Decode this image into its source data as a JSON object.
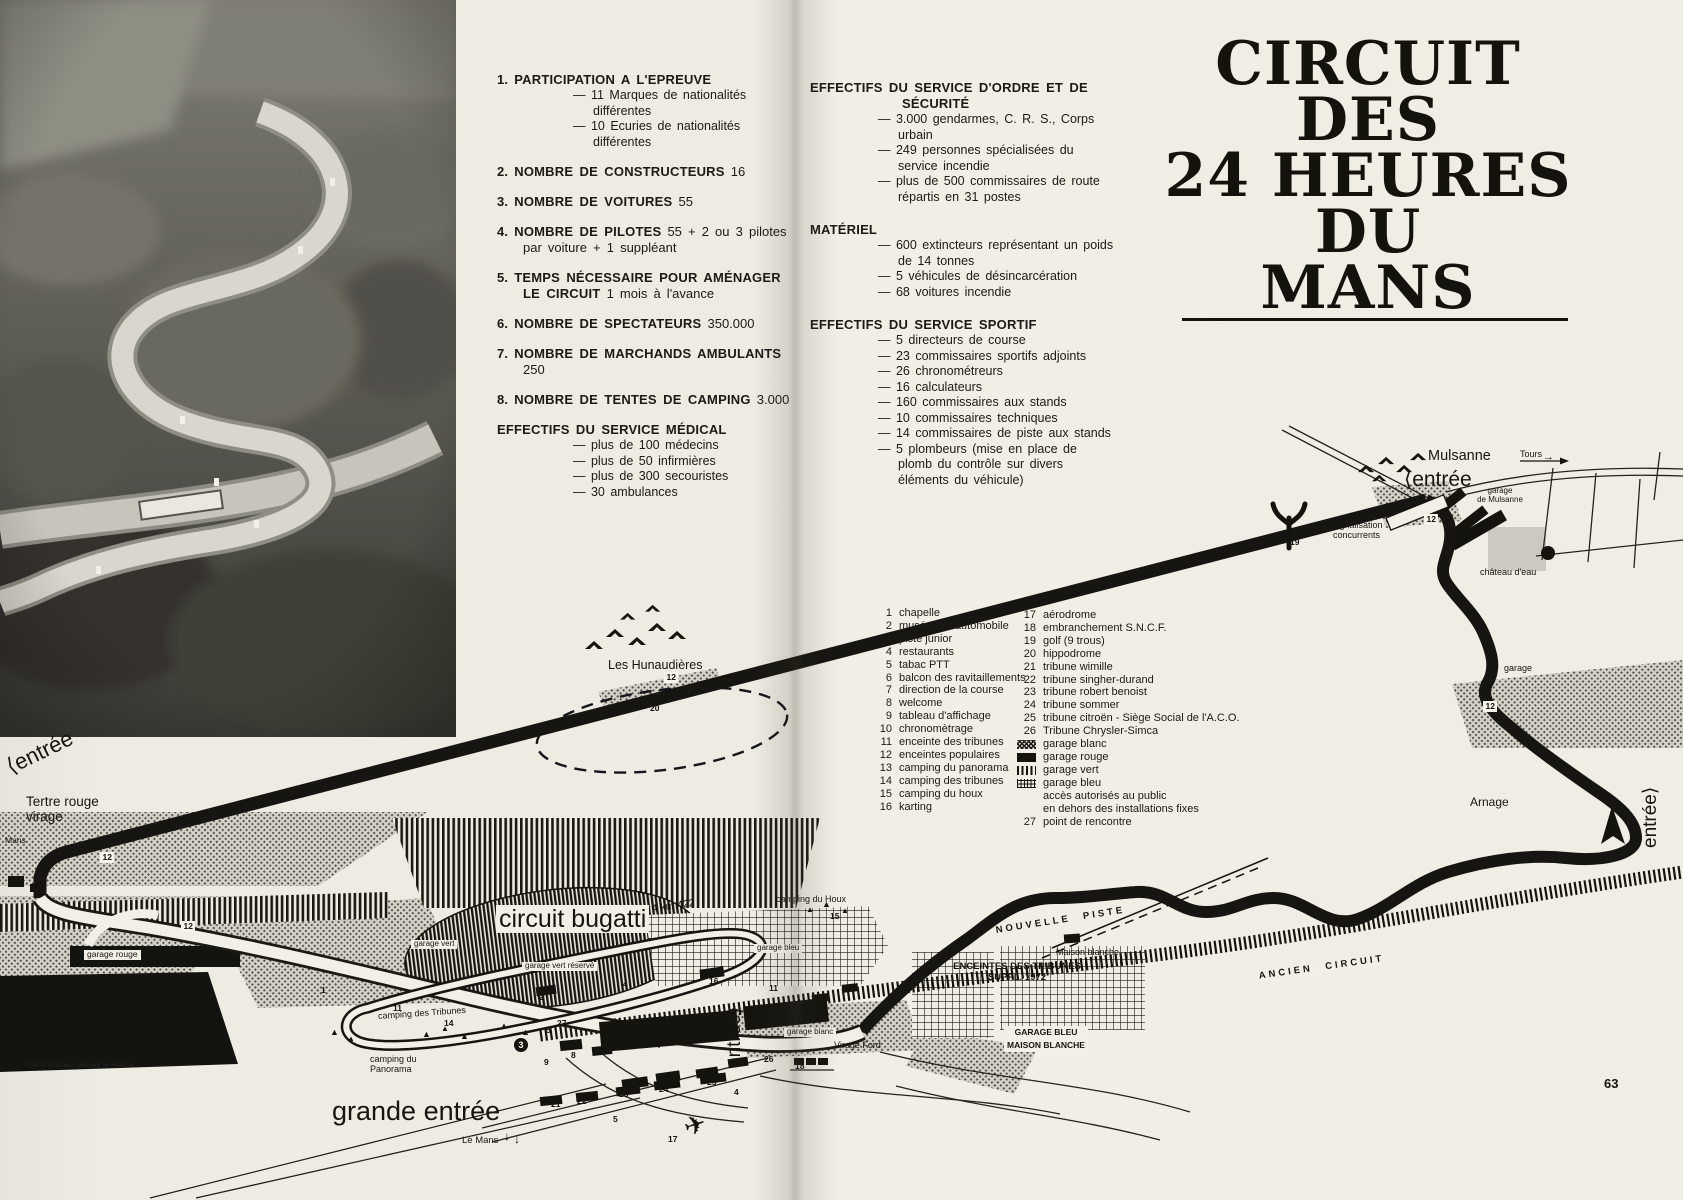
{
  "page": {
    "footer_left": "O P G conseil - printed in France",
    "page_number": "63"
  },
  "colors": {
    "paper": "#efece3",
    "ink": "#1b1a16"
  },
  "title": {
    "lines": [
      "CIRCUIT",
      "DES",
      "24 HEURES",
      "DU",
      "MANS"
    ]
  },
  "stats_left": {
    "items": [
      {
        "num": "1.",
        "title": "PARTICIPATION A L'EPREUVE",
        "value": "",
        "subs": [
          "— 11 Marques de nationalités différentes",
          "— 10 Ecuries de nationalités différentes"
        ]
      },
      {
        "num": "2.",
        "title": "NOMBRE DE CONSTRUCTEURS",
        "value": "16"
      },
      {
        "num": "3.",
        "title": "NOMBRE DE VOITURES",
        "value": "55"
      },
      {
        "num": "4.",
        "title": "NOMBRE DE PILOTES",
        "value": "55 + 2 ou 3 pilotes par voiture + 1 suppléant"
      },
      {
        "num": "5.",
        "title": "TEMPS NÉCESSAIRE POUR AMÉNAGER LE CIRCUIT",
        "value": "1 mois à l'avance"
      },
      {
        "num": "6.",
        "title": "NOMBRE DE SPECTATEURS",
        "value": "350.000"
      },
      {
        "num": "7.",
        "title": "NOMBRE DE MARCHANDS AMBULANTS",
        "value": "250"
      },
      {
        "num": "8.",
        "title": "NOMBRE DE TENTES DE CAMPING",
        "value": "3.000"
      },
      {
        "num": "",
        "title": "EFFECTIFS DU SERVICE MÉDICAL",
        "value": "",
        "subs": [
          "— plus de 100 médecins",
          "— plus de 50 infirmières",
          "— plus de 300 secouristes",
          "— 30 ambulances"
        ]
      }
    ]
  },
  "stats_right": {
    "sections": [
      {
        "title": "EFFECTIFS DU SERVICE D'ORDRE ET DE SÉCURITÉ",
        "subs": [
          "— 3.000 gendarmes, C. R. S., Corps urbain",
          "— 249 personnes spécialisées du service incendie",
          "— plus de 500 commissaires de route répartis en 31 postes"
        ]
      },
      {
        "title": "MATÉRIEL",
        "subs": [
          "— 600 extincteurs représentant un poids de 14 tonnes",
          "— 5 véhicules de désincarcération",
          "— 68 voitures incendie"
        ]
      },
      {
        "title": "EFFECTIFS DU SERVICE SPORTIF",
        "subs": [
          "— 5 directeurs de course",
          "— 23 commissaires sportifs adjoints",
          "— 26 chronométreurs",
          "— 16 calculateurs",
          "— 160 commissaires aux stands",
          "— 10 commissaires techniques",
          "— 14 commissaires de piste aux stands",
          "— 5 plombeurs (mise en place de plomb du contrôle sur divers éléments du véhicule)"
        ]
      }
    ]
  },
  "legend": {
    "col1": [
      {
        "n": "1",
        "label": "chapelle"
      },
      {
        "n": "2",
        "label": "musée de l'automobile"
      },
      {
        "n": "3",
        "label": "piste junior"
      },
      {
        "n": "4",
        "label": "restaurants"
      },
      {
        "n": "5",
        "label": "tabac PTT"
      },
      {
        "n": "6",
        "label": "balcon des ravitaillements"
      },
      {
        "n": "7",
        "label": "direction de la course"
      },
      {
        "n": "8",
        "label": "welcome"
      },
      {
        "n": "9",
        "label": "tableau d'affichage"
      },
      {
        "n": "10",
        "label": "chronomètrage"
      },
      {
        "n": "11",
        "label": "enceinte des tribunes"
      },
      {
        "n": "12",
        "label": "enceintes populaires"
      },
      {
        "n": "13",
        "label": "camping du panorama"
      },
      {
        "n": "14",
        "label": "camping des tribunes"
      },
      {
        "n": "15",
        "label": "camping du houx"
      },
      {
        "n": "16",
        "label": "karting"
      }
    ],
    "col2": [
      {
        "n": "17",
        "label": "aérodrome"
      },
      {
        "n": "18",
        "label": "embranchement S.N.C.F."
      },
      {
        "n": "19",
        "label": "golf (9 trous)"
      },
      {
        "n": "20",
        "label": "hippodrome"
      },
      {
        "n": "21",
        "label": "tribune wimille"
      },
      {
        "n": "22",
        "label": "tribune singher-durand"
      },
      {
        "n": "23",
        "label": "tribune robert benoist"
      },
      {
        "n": "24",
        "label": "tribune citroën - Siège Social de l'A.C.O.",
        "override_n": "25"
      },
      {
        "n": "24x",
        "label": ""
      },
      {
        "n": "26",
        "label": "Tribune Chrysler-Simca"
      },
      {
        "swatch": "dots",
        "label": "garage blanc"
      },
      {
        "swatch": "solid",
        "label": "garage rouge"
      },
      {
        "swatch": "vlines",
        "label": "garage vert"
      },
      {
        "swatch": "grid",
        "label": "garage bleu"
      },
      {
        "label": "accès autorisés au public"
      },
      {
        "label": "en dehors des installations fixes"
      },
      {
        "n": "27",
        "label": "point de rencontre"
      }
    ],
    "col2_fixed": [
      {
        "n": "17",
        "label": "aérodrome"
      },
      {
        "n": "18",
        "label": "embranchement S.N.C.F."
      },
      {
        "n": "19",
        "label": "golf (9 trous)"
      },
      {
        "n": "20",
        "label": "hippodrome"
      },
      {
        "n": "21",
        "label": "tribune wimille"
      },
      {
        "n": "22",
        "label": "tribune singher-durand"
      },
      {
        "n": "23",
        "label": "tribune robert benoist"
      },
      {
        "n": "24",
        "label": "tribune sommer"
      },
      {
        "n": "25",
        "label": "tribune citroën - Siège Social de l'A.C.O."
      },
      {
        "n": "26",
        "label": "Tribune Chrysler-Simca"
      },
      {
        "swatch": "dots",
        "label": "garage blanc"
      },
      {
        "swatch": "solid",
        "label": "garage rouge"
      },
      {
        "swatch": "vlines",
        "label": "garage vert"
      },
      {
        "swatch": "grid",
        "label": "garage bleu"
      },
      {
        "label": "accès autorisés au public"
      },
      {
        "label": "en dehors des installations fixes"
      },
      {
        "n": "27",
        "label": "point de rencontre"
      }
    ]
  },
  "map": {
    "labels": [
      {
        "name": "label-les-hunaudieres",
        "text": "Les Hunaudières",
        "x": 608,
        "y": 658,
        "size": 12.5
      },
      {
        "name": "label-entree-tertre",
        "text": "⟨entrée",
        "x": 8,
        "y": 756,
        "size": 22,
        "rotate": -26
      },
      {
        "name": "label-tertre-rouge",
        "text": "Tertre rouge\nvirage",
        "x": 26,
        "y": 794,
        "size": 13.5
      },
      {
        "name": "label-mans",
        "text": "Mans",
        "x": 5,
        "y": 836,
        "size": 8.5
      },
      {
        "name": "label-garage-rouge",
        "text": "garage rouge",
        "x": 84,
        "y": 950,
        "size": 8.5,
        "boxed": true
      },
      {
        "name": "label-camping-panorama",
        "text": "camping du\nPanorama",
        "x": 370,
        "y": 1054,
        "size": 9
      },
      {
        "name": "label-camping-tribunes",
        "text": "camping des Tribunes",
        "x": 378,
        "y": 1011,
        "size": 9,
        "rotate": -4
      },
      {
        "name": "label-circuit-bugatti",
        "text": "circuit bugatti",
        "x": 496,
        "y": 905,
        "size": 25,
        "boxed": true
      },
      {
        "name": "label-bugatti-length",
        "text": "4 km 422",
        "x": 652,
        "y": 904,
        "size": 10.5,
        "rotate": -8
      },
      {
        "name": "label-garage-vert",
        "text": "garage vert",
        "x": 411,
        "y": 940,
        "size": 8,
        "boxed": true
      },
      {
        "name": "label-garage-vert-reserve",
        "text": "garage vert réservé",
        "x": 522,
        "y": 962,
        "size": 8,
        "boxed": true
      },
      {
        "name": "label-garage-bleu",
        "text": "garage bleu",
        "x": 754,
        "y": 944,
        "size": 8,
        "boxed": true
      },
      {
        "name": "label-camping-houx",
        "text": "camping du Houx",
        "x": 776,
        "y": 894,
        "size": 9
      },
      {
        "name": "label-grande-entree",
        "text": "grande entrée",
        "x": 332,
        "y": 1096,
        "size": 27
      },
      {
        "name": "label-le-mans",
        "text": "Le Mans",
        "x": 462,
        "y": 1136,
        "size": 9.5
      },
      {
        "name": "label-entree-centre",
        "text": "entrée⟩",
        "x": 724,
        "y": 1068,
        "size": 19,
        "rotate": -90
      },
      {
        "name": "label-virage-ford",
        "text": "Virage Ford",
        "x": 834,
        "y": 1040,
        "size": 9
      },
      {
        "name": "label-garage-blanc",
        "text": "garage blanc",
        "x": 784,
        "y": 1028,
        "size": 8,
        "boxed": true
      },
      {
        "name": "label-nouvelle-piste",
        "text": "NOUVELLE PISTE",
        "x": 996,
        "y": 926,
        "size": 9.5,
        "rotate": -9,
        "spaced": true
      },
      {
        "name": "label-enceintes-suppl",
        "text": "ENCEINTES DES TRIBUNES\nSUPPL. 1972",
        "x": 1017,
        "y": 962,
        "size": 9.5,
        "bold": true,
        "align": "center"
      },
      {
        "name": "label-ancien-circuit",
        "text": "ANCIEN CIRCUIT",
        "x": 1256,
        "y": 972,
        "size": 9.5,
        "rotate": -8,
        "spaced": true,
        "boxed": true
      },
      {
        "name": "label-maison-blanche",
        "text": "Maison blanche",
        "x": 1056,
        "y": 947,
        "size": 9
      },
      {
        "name": "label-garage-bleu-maison-blanche",
        "text": "GARAGE BLEU\nMAISON BLANCHE",
        "x": 1046,
        "y": 1026,
        "size": 8.5,
        "bold": true,
        "boxed": true,
        "align": "center",
        "lh": "1.55"
      },
      {
        "name": "label-mulsanne",
        "text": "Mulsanne",
        "x": 1428,
        "y": 448,
        "size": 14.5
      },
      {
        "name": "label-tours",
        "text": "Tours",
        "x": 1520,
        "y": 449,
        "size": 9
      },
      {
        "name": "label-entree-mulsanne",
        "text": "⟨entrée",
        "x": 1404,
        "y": 468,
        "size": 21
      },
      {
        "name": "label-garage-de-mulsanne",
        "text": "garage\nde Mulsanne",
        "x": 1500,
        "y": 487,
        "size": 8,
        "align": "center"
      },
      {
        "name": "label-signalisation",
        "text": "signalisation\nconcurrents",
        "x": 1333,
        "y": 520,
        "size": 9
      },
      {
        "name": "label-chateau-eau",
        "text": "château d'eau",
        "x": 1480,
        "y": 567,
        "size": 9
      },
      {
        "name": "label-garage-arnage",
        "text": "garage",
        "x": 1504,
        "y": 663,
        "size": 9
      },
      {
        "name": "label-arnage",
        "text": "Arnage",
        "x": 1470,
        "y": 796,
        "size": 12
      },
      {
        "name": "label-entree-arnage",
        "text": "entrée⟩",
        "x": 1640,
        "y": 848,
        "size": 19,
        "rotate": -90
      }
    ],
    "numbers": [
      {
        "n": "12",
        "x": 664,
        "y": 672,
        "boxed": true
      },
      {
        "n": "20",
        "x": 650,
        "y": 704
      },
      {
        "n": "19",
        "x": 1290,
        "y": 538
      },
      {
        "n": "12",
        "x": 1424,
        "y": 514,
        "boxed": true
      },
      {
        "n": "12",
        "x": 1483,
        "y": 701,
        "boxed": true
      },
      {
        "n": "12",
        "x": 100,
        "y": 852,
        "boxed": true
      },
      {
        "n": "12",
        "x": 181,
        "y": 921,
        "boxed": true
      },
      {
        "n": "1",
        "x": 321,
        "y": 986
      },
      {
        "n": "2",
        "x": 539,
        "y": 993
      },
      {
        "n": "3",
        "x": 514,
        "y": 1038,
        "circle": true
      },
      {
        "n": "5",
        "x": 546,
        "y": 1026
      },
      {
        "n": "27",
        "x": 557,
        "y": 1019
      },
      {
        "n": "9",
        "x": 544,
        "y": 1058
      },
      {
        "n": "8",
        "x": 571,
        "y": 1051
      },
      {
        "n": "6",
        "x": 630,
        "y": 1024
      },
      {
        "n": "7",
        "x": 657,
        "y": 1041
      },
      {
        "n": "10",
        "x": 791,
        "y": 1017
      },
      {
        "n": "11",
        "x": 769,
        "y": 984
      },
      {
        "n": "11",
        "x": 393,
        "y": 1004
      },
      {
        "n": "14",
        "x": 444,
        "y": 1019
      },
      {
        "n": "15",
        "x": 830,
        "y": 912
      },
      {
        "n": "16",
        "x": 709,
        "y": 977
      },
      {
        "n": "21",
        "x": 551,
        "y": 1100
      },
      {
        "n": "22",
        "x": 577,
        "y": 1097
      },
      {
        "n": "23",
        "x": 619,
        "y": 1090
      },
      {
        "n": "24",
        "x": 659,
        "y": 1085
      },
      {
        "n": "25",
        "x": 707,
        "y": 1078
      },
      {
        "n": "4",
        "x": 623,
        "y": 980
      },
      {
        "n": "4",
        "x": 734,
        "y": 1088
      },
      {
        "n": "5",
        "x": 613,
        "y": 1115
      },
      {
        "n": "17",
        "x": 668,
        "y": 1135
      },
      {
        "n": "26",
        "x": 764,
        "y": 1055
      },
      {
        "n": "18",
        "x": 795,
        "y": 1062
      }
    ],
    "icons": [
      {
        "name": "tent-icon",
        "glyph": "▲",
        "x": 330,
        "y": 1028,
        "size": 9
      },
      {
        "name": "tent-icon",
        "glyph": "▲",
        "x": 347,
        "y": 1035,
        "size": 8
      },
      {
        "name": "tent-icon",
        "glyph": "▲",
        "x": 422,
        "y": 1030,
        "size": 9
      },
      {
        "name": "tent-icon",
        "glyph": "▲",
        "x": 441,
        "y": 1025,
        "size": 8
      },
      {
        "name": "tent-icon",
        "glyph": "▲",
        "x": 460,
        "y": 1032,
        "size": 9
      },
      {
        "name": "tent-icon",
        "glyph": "▲",
        "x": 500,
        "y": 1022,
        "size": 8
      },
      {
        "name": "tent-icon",
        "glyph": "▲",
        "x": 521,
        "y": 1028,
        "size": 9
      },
      {
        "name": "tent-icon",
        "glyph": "▲",
        "x": 806,
        "y": 906,
        "size": 8
      },
      {
        "name": "tent-icon",
        "glyph": "▲",
        "x": 822,
        "y": 900,
        "size": 9
      },
      {
        "name": "tent-icon",
        "glyph": "▲",
        "x": 841,
        "y": 907,
        "size": 8
      },
      {
        "name": "plane-icon",
        "glyph": "✈",
        "x": 684,
        "y": 1112,
        "size": 26,
        "rotate": -18
      },
      {
        "name": "arrow-down-icon",
        "glyph": "↓",
        "x": 504,
        "y": 1130,
        "size": 12
      },
      {
        "name": "arrow-down-icon",
        "glyph": "↓",
        "x": 514,
        "y": 1133,
        "size": 12
      },
      {
        "name": "arrow-right-icon",
        "glyph": "→",
        "x": 1543,
        "y": 452,
        "size": 11
      }
    ]
  }
}
